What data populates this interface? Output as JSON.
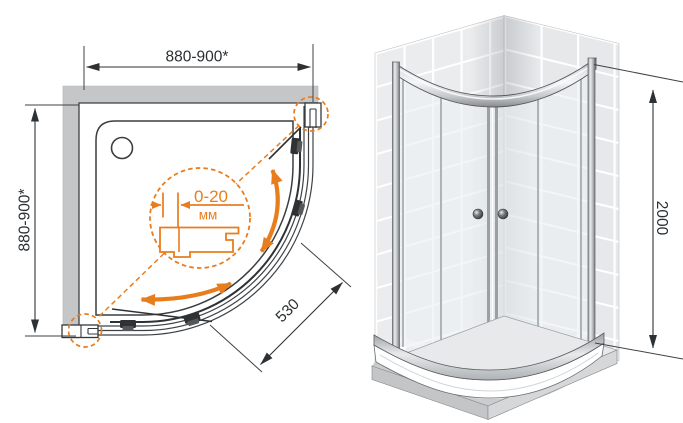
{
  "drawing_title": "quadrant shower enclosure installation diagram",
  "plan": {
    "width_label": "880-900*",
    "depth_label": "880-900*",
    "entry_label": "530",
    "adjustment": {
      "value": "0-20",
      "unit": "мм"
    }
  },
  "iso": {
    "height_label": "2000"
  },
  "colors": {
    "accent_orange": "#e87d1e",
    "wall_gray": "#c5c6c7",
    "line_dark": "#2e3134",
    "tile_gray": "#eaecee",
    "metal_silver": "#c6c9cb"
  }
}
